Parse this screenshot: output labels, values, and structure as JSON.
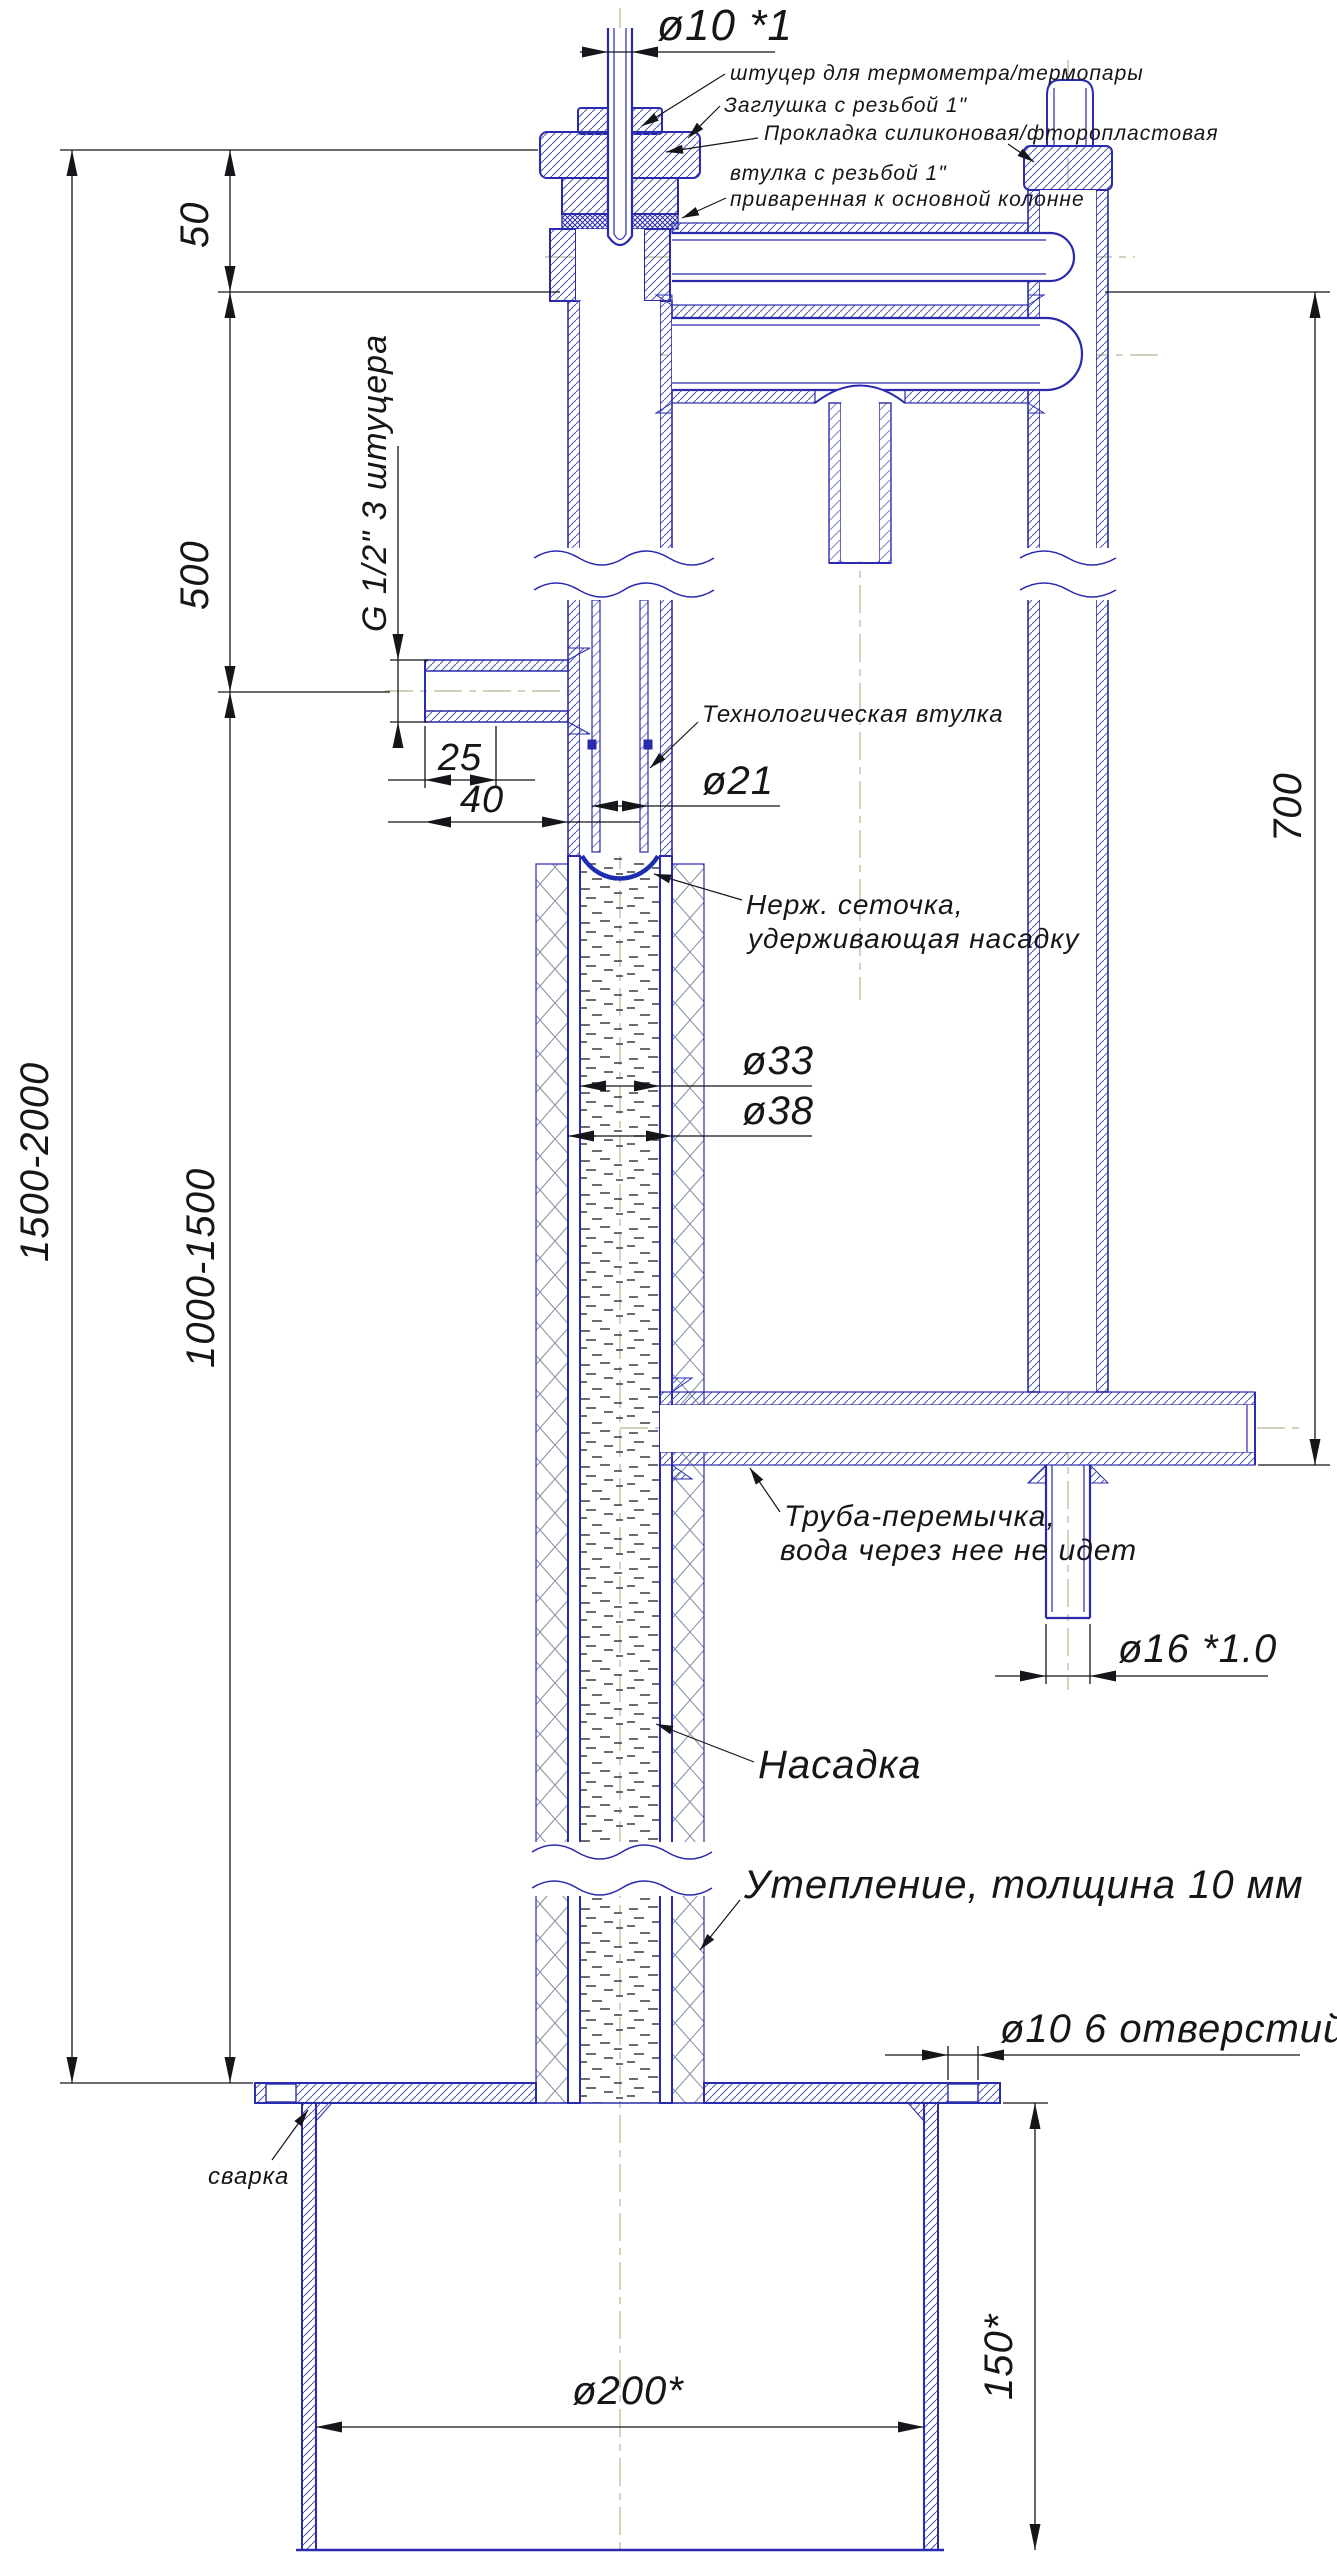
{
  "drawing": {
    "kind": "engineering-section-drawing",
    "language": "ru",
    "subject": "distillation-column-with-cooler-and-tank-flange",
    "colors": {
      "part_line": "#2a2aad",
      "dim_line": "#1c1c1c",
      "centerline": "#b6b690",
      "metal_hatch": "#5560b2",
      "insulation_hatch": "#9097a8",
      "background": "#ffffff"
    },
    "dims": {
      "thermo_tube": "ø10 *1",
      "top_offset": "50",
      "upper_section": "500",
      "overall_height": "1500-2000",
      "packed_height": "1000-1500",
      "right_column_drop": "700",
      "nozzle_inset": "25",
      "nozzle_length": "40",
      "tech_sleeve_bore": "ø21",
      "packing_bore": "ø33",
      "column_od": "ø38",
      "return_tube": "ø16 *1.0",
      "flange_holes": "ø10  6 отверстий",
      "tank_diameter": "ø200*",
      "tank_neck_height": "150*",
      "nozzle_note": "G 1/2\"  3 штуцера"
    },
    "callouts": {
      "thermo_port": "штуцер для термометра/термопары",
      "plug": "Заглушка с резьбой 1\"",
      "gasket": "Прокладка силиконовая/фторопластовая",
      "sleeve_line1": "втулка с резьбой 1\"",
      "sleeve_line2": "приваренная к основной колонне",
      "tech_sleeve": "Технологическая втулка",
      "mesh_line1": "Нерж. сеточка,",
      "mesh_line2": "удерживающая насадку",
      "jumper_line1": "Труба-перемычка,",
      "jumper_line2": "вода через нее не идет",
      "packing": "Насадка",
      "insulation": "Утепление, толщина 10 мм",
      "weld": "сварка"
    }
  }
}
